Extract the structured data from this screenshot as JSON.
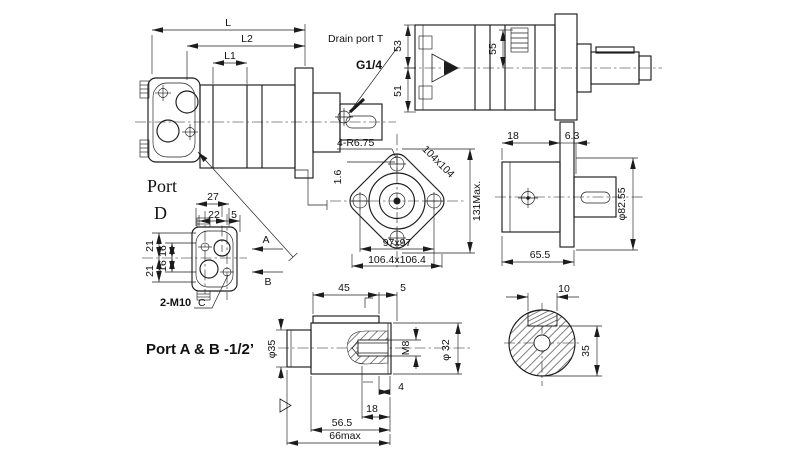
{
  "side_view": {
    "dim_L": "L",
    "dim_L2": "L2",
    "dim_L1": "L1",
    "drain_label": "Drain port T",
    "drain_thread": "G1/4"
  },
  "top_view": {
    "dim_53": "53",
    "dim_51": "51",
    "dim_55": "55"
  },
  "flange_view": {
    "corner_note": "4-R6.75",
    "roughness": "1.6",
    "bolt_square": "104x104",
    "max_dim": "131Max.",
    "square_inner": "97x97",
    "square_outer": "106.4x106.4"
  },
  "end_view": {
    "dim_18": "18",
    "dim_63": "6.3",
    "dim_dia": "φ82.55",
    "dim_655": "65.5"
  },
  "port_view": {
    "title_word": "Port",
    "title_letter": "D",
    "dim_27": "27",
    "dim_22": "22",
    "dim_5": "5",
    "dim_21a": "21",
    "dim_21b": "21",
    "dim_16a": "16",
    "dim_16b": "16",
    "bolt_note": "2-M10",
    "bolt_ref": "C",
    "flow_a": "A",
    "flow_b": "B"
  },
  "port_note": "Port A & B -1/2’",
  "shaft_view": {
    "dim_45": "45",
    "dim_5": "5",
    "dim_dia35": "φ35",
    "dim_m8": "M8",
    "dim_dia32": "φ 32",
    "dim_4": "4",
    "dim_18": "18",
    "dim_565": "56.5",
    "dim_66": "66max"
  },
  "key_section_view": {
    "dim_10": "10",
    "dim_35": "35"
  }
}
